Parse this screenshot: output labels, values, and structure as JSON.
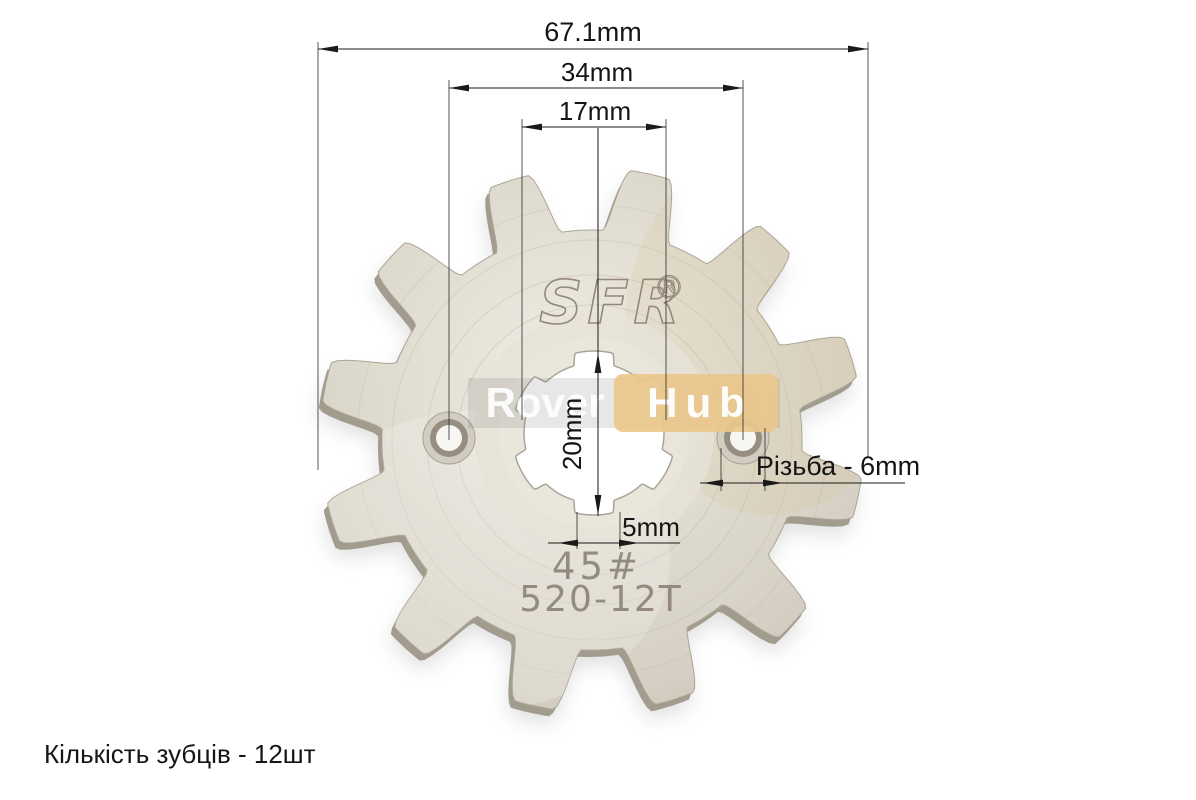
{
  "caption": {
    "teeth_count": "Кількість зубців - 12шт"
  },
  "dimensions": {
    "outer_diameter": "67.1mm",
    "hole_spacing": "34mm",
    "spline_inner_diameter": "17mm",
    "spline_outer_diameter": "20mm",
    "groove_width": "5mm",
    "thread": "Різьба - 6mm"
  },
  "engravings": {
    "brand": "SFR",
    "registered_mark": "®",
    "steel_grade": "45#",
    "model": "520-12T"
  },
  "watermark": {
    "left": "Rover",
    "right": "Hub"
  },
  "colors": {
    "background": "#ffffff",
    "metal_body": "#dcd8cc",
    "metal_edge_shadow": "#a29c8f",
    "engraving": "#8a8073",
    "dimension_lines": "#1a1a1a",
    "watermark_box": "#ebc78c",
    "watermark_text": "#ffffff"
  }
}
